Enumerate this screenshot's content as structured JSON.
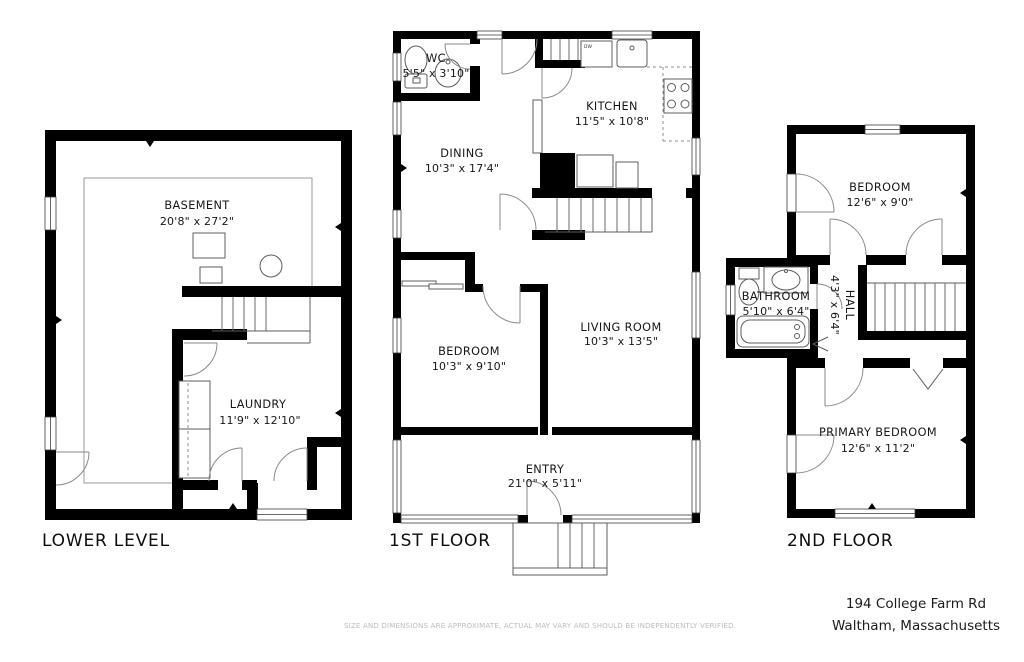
{
  "meta": {
    "disclaimer": "SIZE AND DIMENSIONS ARE APPROXIMATE, ACTUAL MAY VARY AND SHOULD BE INDEPENDENTLY VERIFIED.",
    "address_line1": "194 College Farm Rd",
    "address_line2": "Waltham, Massachusetts"
  },
  "floors": [
    {
      "label": "LOWER LEVEL",
      "rooms": [
        {
          "name": "BASEMENT",
          "dims": "20'8\" x 27'2\""
        },
        {
          "name": "LAUNDRY",
          "dims": "11'9\" x 12'10\""
        }
      ]
    },
    {
      "label": "1ST FLOOR",
      "dw_label": "DW",
      "rooms": [
        {
          "name": "WC",
          "dims": "5'5\" x 3'10\""
        },
        {
          "name": "DINING",
          "dims": "10'3\" x 17'4\""
        },
        {
          "name": "KITCHEN",
          "dims": "11'5\" x 10'8\""
        },
        {
          "name": "BEDROOM",
          "dims": "10'3\" x 9'10\""
        },
        {
          "name": "LIVING ROOM",
          "dims": "10'3\" x 13'5\""
        },
        {
          "name": "ENTRY",
          "dims": "21'0\" x 5'11\""
        }
      ]
    },
    {
      "label": "2ND FLOOR",
      "rooms": [
        {
          "name": "BEDROOM",
          "dims": "12'6\" x 9'0\""
        },
        {
          "name": "BATHROOM",
          "dims": "5'10\" x 6'4\""
        },
        {
          "name": "HALL",
          "dims": "4'3\" x 6'4\""
        },
        {
          "name": "PRIMARY BEDROOM",
          "dims": "12'6\" x 11'2\""
        }
      ]
    }
  ]
}
